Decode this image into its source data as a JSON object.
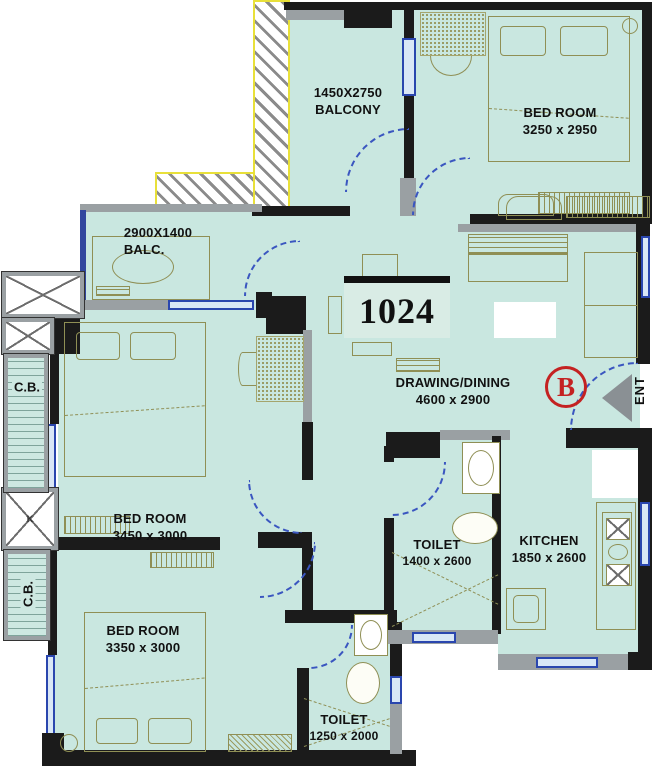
{
  "plan": {
    "unit_number": "1024",
    "block_badge": "B",
    "entrance_label": "ENT",
    "rooms": {
      "balcony_top": {
        "dims": "1450X2750",
        "name": "BALCONY"
      },
      "bedroom_top": {
        "name": "BED ROOM",
        "dims": "3250 x 2950"
      },
      "balcony_left": {
        "dims": "2900X1400",
        "name": "BALC."
      },
      "bedroom_mid": {
        "name": "BED ROOM",
        "dims": "3450 x 3000"
      },
      "drawing_dining": {
        "name": "DRAWING/DINING",
        "dims": "4600 x 2900"
      },
      "toilet_main": {
        "name": "TOILET",
        "dims": "1400 x 2600"
      },
      "kitchen": {
        "name": "KITCHEN",
        "dims": "1850 x 2600"
      },
      "bedroom_bottom": {
        "name": "BED ROOM",
        "dims": "3350 x 3000"
      },
      "toilet_small": {
        "name": "TOILET",
        "dims": "1250 x 2000"
      },
      "cupboard_top": {
        "label": "C.B."
      },
      "cupboard_bottom": {
        "label": "C.B."
      },
      "lift_mark": {
        "label": "K"
      }
    },
    "colors": {
      "room_fill": "#c9e7e0",
      "wall_dark": "#1b1b1b",
      "wall_gray": "#9aa0a3",
      "window_blue": "#2a46ae",
      "door_arc_blue": "#3a56c0",
      "furniture_olive": "#8f8f55",
      "accent_red": "#c42222",
      "hatch_yellow": "#e8e03a"
    }
  }
}
